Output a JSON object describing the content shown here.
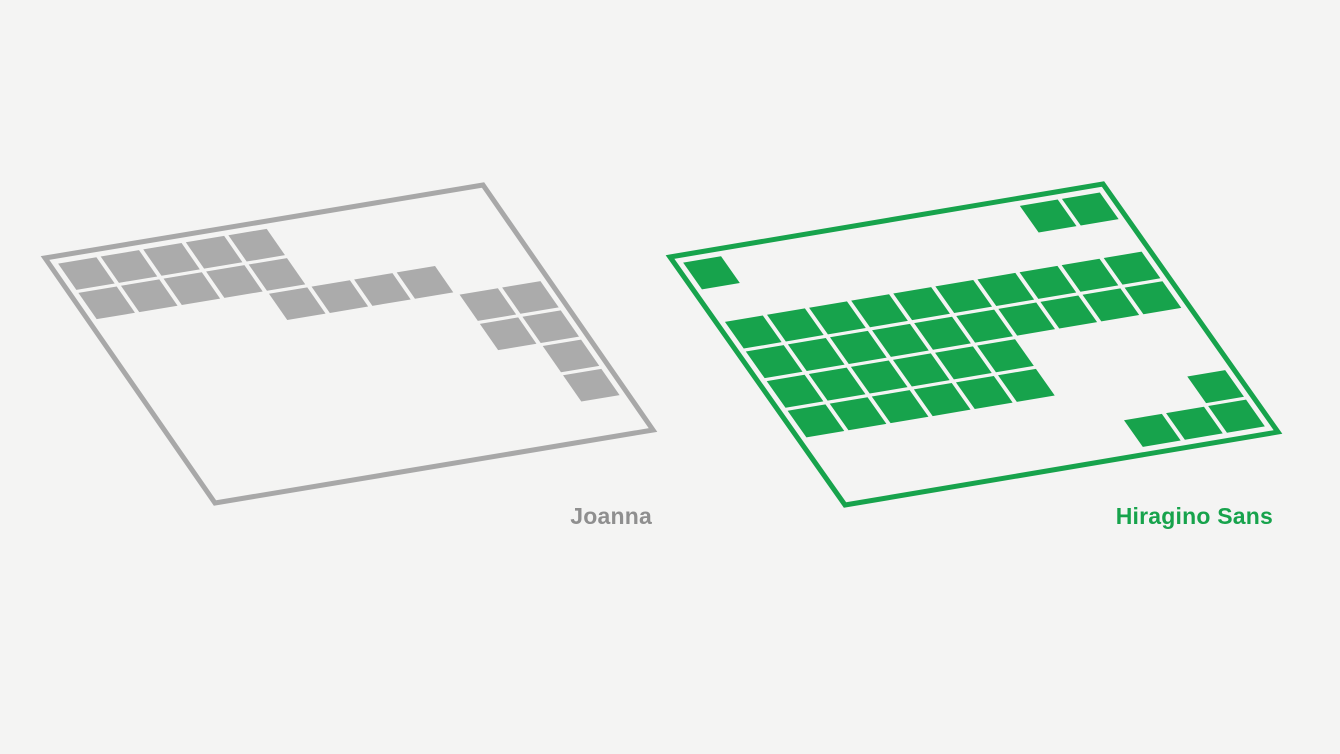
{
  "page": {
    "background_color": "#f4f4f3"
  },
  "chart_data": {
    "type": "heatmap",
    "grid_rows": 8,
    "grid_cols": 10,
    "cell_states": {
      "1": "filled",
      "0": "empty"
    },
    "series": [
      {
        "name": "Joanna",
        "label": "Joanna",
        "cell_color": "#ababab",
        "border_color": "#a8a8a8",
        "label_color": "#8f8f8f",
        "filled_count": 20,
        "rows": [
          "1111100000",
          "1111100000",
          "0000111100",
          "0000000011",
          "0000000011",
          "0000000001",
          "0000000001",
          "0000000000"
        ]
      },
      {
        "name": "Hiragino Sans",
        "label": "Hiragino Sans",
        "cell_color": "#17a34c",
        "border_color": "#17a34c",
        "label_color": "#17a34c",
        "filled_count": 39,
        "rows": [
          "1000000011",
          "0000000000",
          "1111111111",
          "1111111111",
          "1111110000",
          "1111110000",
          "0000000001",
          "0000000111"
        ]
      }
    ]
  }
}
